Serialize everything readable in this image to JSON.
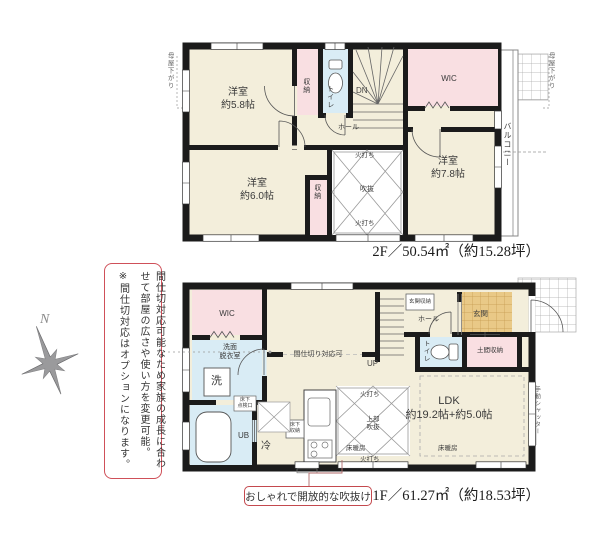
{
  "sidebar": {
    "compass_label": "N",
    "note": {
      "line1": "間仕切対応可能なため家族の成長に合わせて部屋の広さや使い方を変更可能。",
      "line2": "※間仕切対応はオプションになります。"
    }
  },
  "floor2": {
    "area_label": "2F／50.54㎡（約15.28坪）",
    "annotations": {
      "moyasagari_left": "母屋下がり",
      "moyasagari_right": "母屋下がり",
      "balcony": "バルコニー",
      "hiuchi_top": "火打ち",
      "hiuchi_bottom": "火打ち",
      "void": "吹抜"
    },
    "rooms": {
      "bedroom_58": "洋室\n約5.8帖",
      "bedroom_60": "洋室\n約6.0帖",
      "bedroom_78": "洋室\n約7.8帖",
      "wic": "WIC",
      "toilet": "トイレ",
      "hall": "ホール",
      "stairs_dn": "DN",
      "closet_1": "収納",
      "closet_2": "収納"
    }
  },
  "floor1": {
    "area_label": "1F／61.27㎡（約18.53坪）",
    "annotations": {
      "hiuchi_top": "火打ち",
      "hiuchi_bottom": "火打ち",
      "void_upper": "上部\n吹抜",
      "floor_heating_left": "床暖房",
      "floor_heating_right": "床暖房",
      "shutter": "手動シャッター",
      "partition_ready": "間仕切り対応可"
    },
    "rooms": {
      "ldk": "LDK\n約19.2帖+約5.0帖",
      "wic": "WIC",
      "washroom": "洗面\n脱衣室",
      "washer": "洗",
      "bath": "UB",
      "fridge": "冷",
      "entrance": "玄関",
      "entrance_storage": "玄関収納",
      "doma_storage": "土間収納",
      "hall": "ホール",
      "stairs_up": "UP",
      "toilet": "トイレ",
      "underfloor_storage": "床下\n収納",
      "underfloor_hatch": "床下\n点検口"
    }
  },
  "callout": {
    "text": "おしゃれで開放的な吹抜け"
  }
}
